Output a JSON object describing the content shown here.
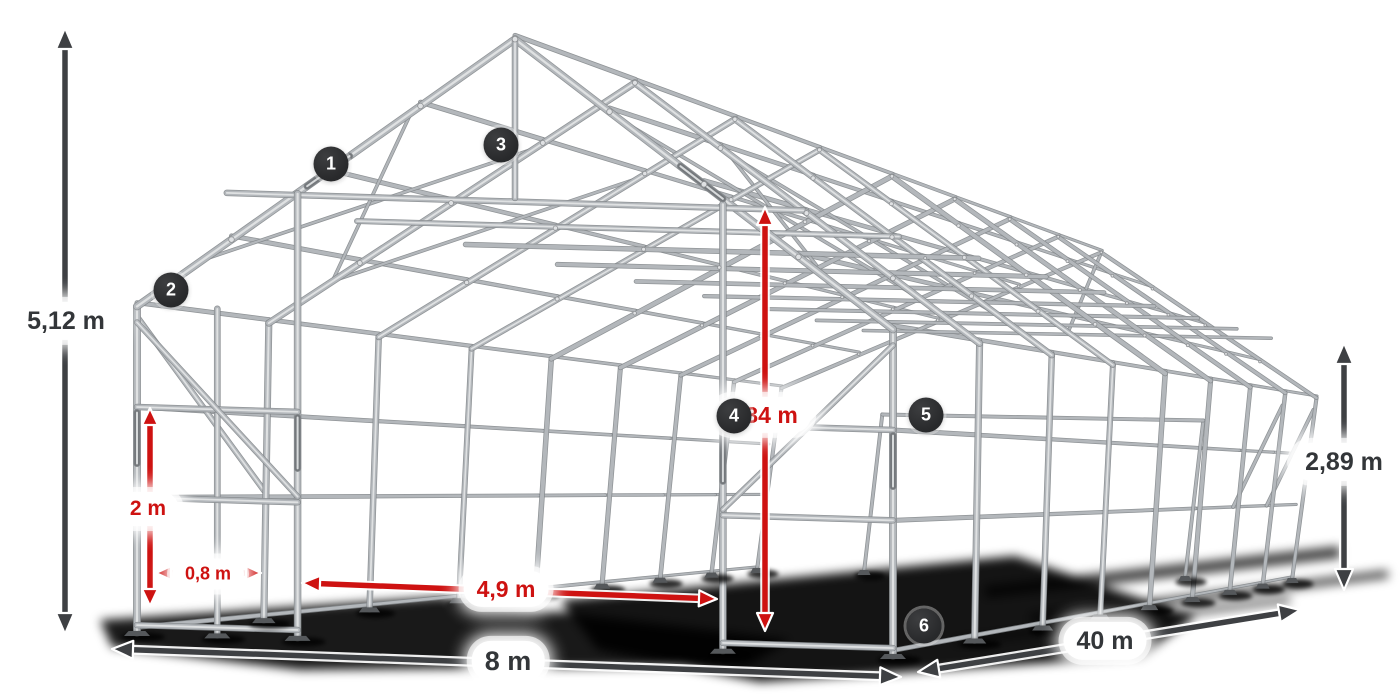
{
  "illustration": {
    "name": "storage-tent-steel-frame-wireframe",
    "tube_color": "#b3b7bb",
    "tube_dark": "#83878b",
    "tube_light": "#e3e5e7",
    "sleeve_color": "#74787c",
    "foot_color": "#55585b",
    "shadow_color": "#000000"
  },
  "hotspots": [
    {
      "number": "1"
    },
    {
      "number": "2"
    },
    {
      "number": "3"
    },
    {
      "number": "4"
    },
    {
      "number": "5"
    },
    {
      "number": "6"
    }
  ],
  "dimensions": {
    "ridge_height": {
      "label": "5,12 m",
      "style": "dark"
    },
    "eave_height": {
      "label": "2,89 m",
      "style": "dark"
    },
    "width": {
      "label": "8 m",
      "style": "dark"
    },
    "length": {
      "label": "40 m",
      "style": "dark"
    },
    "rail_height": {
      "label": "2 m",
      "style": "red"
    },
    "post_spacing": {
      "label": "0,8 m",
      "style": "red"
    },
    "gate_width": {
      "label": "4,9 m",
      "style": "red"
    },
    "clearance_height": {
      "label": "4,34 m",
      "style": "red"
    }
  },
  "colors": {
    "dimension_red": "#ce1211",
    "dimension_dark": "#3e4043",
    "badge_background": "#2d2e30",
    "badge_text": "#ffffff",
    "pill_background": "#ffffff"
  }
}
